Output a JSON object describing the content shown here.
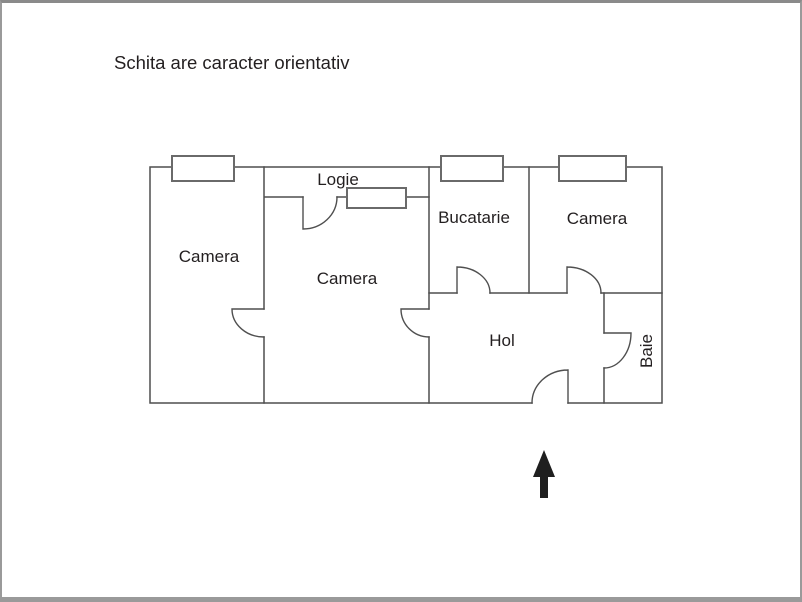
{
  "title": "Schita are caracter orientativ",
  "rooms": {
    "camera_left": "Camera",
    "camera_middle": "Camera",
    "camera_right": "Camera",
    "logie": "Logie",
    "bucatarie": "Bucatarie",
    "hol": "Hol",
    "baie": "Baie"
  },
  "icons": {
    "north_arrow": "arrow-up"
  },
  "colors": {
    "background": "#ffffff",
    "wall": "#4f4f4f",
    "window_frame": "#6a6a6a",
    "door": "#4f4f4f",
    "text": "#231f20",
    "arrow": "#1f1f1f",
    "frame_border": "#9a9a9a"
  }
}
